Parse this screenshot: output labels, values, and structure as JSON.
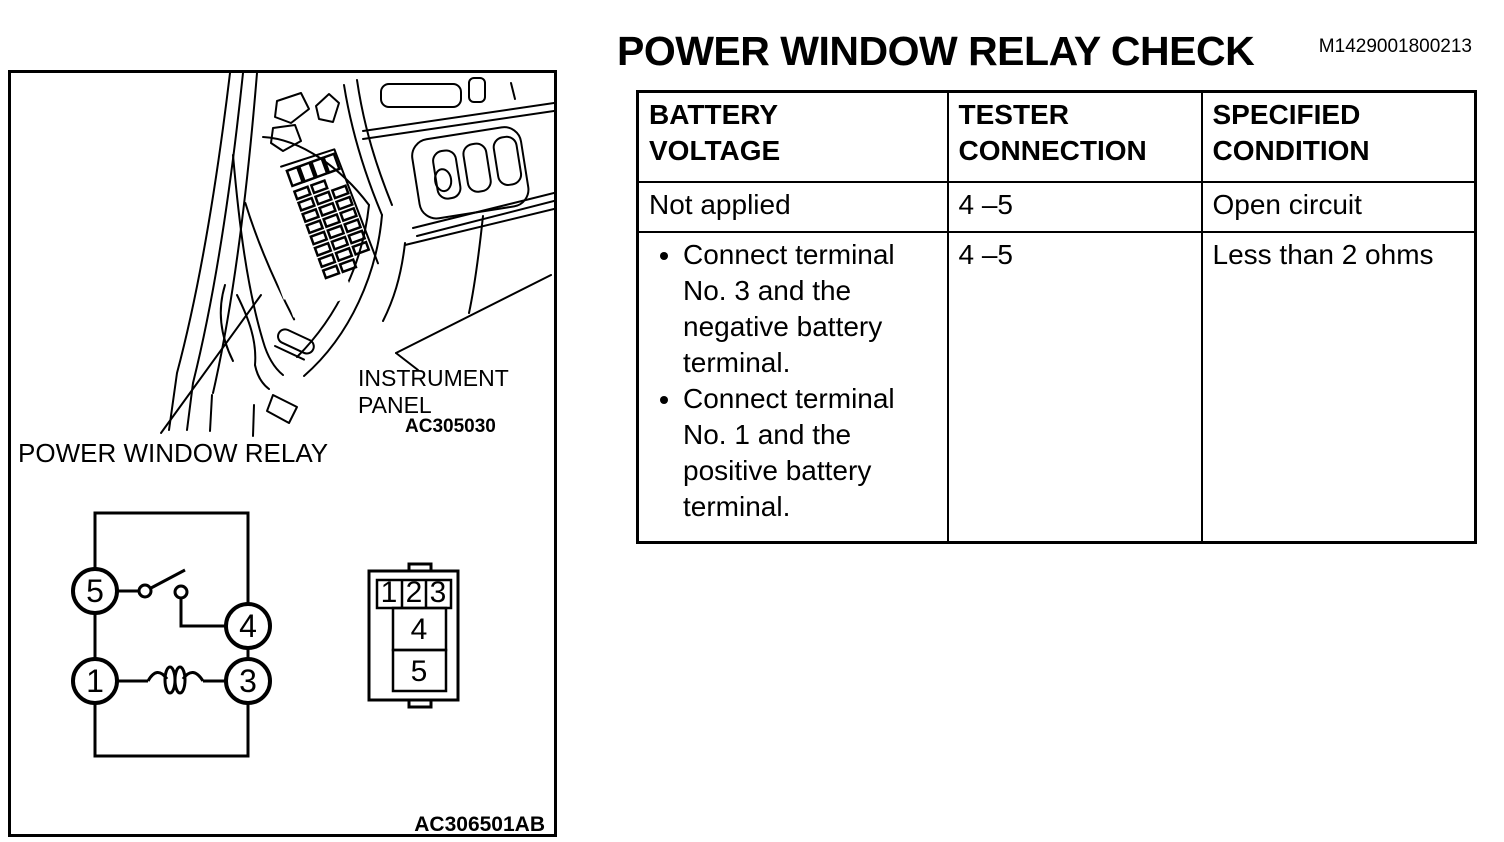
{
  "page": {
    "title": "POWER WINDOW RELAY CHECK",
    "doc_code": "M1429001800213"
  },
  "table": {
    "columns": [
      {
        "label_line1": "BATTERY",
        "label_line2": "VOLTAGE"
      },
      {
        "label_line1": "TESTER",
        "label_line2": "CONNECTION"
      },
      {
        "label_line1": "SPECIFIED",
        "label_line2": "CONDITION"
      }
    ],
    "rows": [
      {
        "battery_voltage": "Not applied",
        "tester_connection": "4 –5",
        "specified_condition": "Open circuit"
      },
      {
        "battery_voltage_bullets": [
          "Connect terminal No. 3 and the negative battery terminal.",
          "Connect terminal No. 1 and the positive battery terminal."
        ],
        "tester_connection": "4 –5",
        "specified_condition": "Less than 2 ohms"
      }
    ]
  },
  "figure": {
    "labels": {
      "instrument_line1": "INSTRUMENT",
      "instrument_line2": "PANEL",
      "photo_code": "AC305030",
      "relay_label": "POWER WINDOW RELAY",
      "diagram_code": "AC306501AB"
    },
    "circuit": {
      "t5": "5",
      "t4": "4",
      "t1": "1",
      "t3": "3"
    },
    "connector": {
      "p1": "1",
      "p2": "2",
      "p3": "3",
      "p4": "4",
      "p5": "5"
    },
    "colors": {
      "ink": "#000000",
      "paper": "#ffffff"
    }
  }
}
